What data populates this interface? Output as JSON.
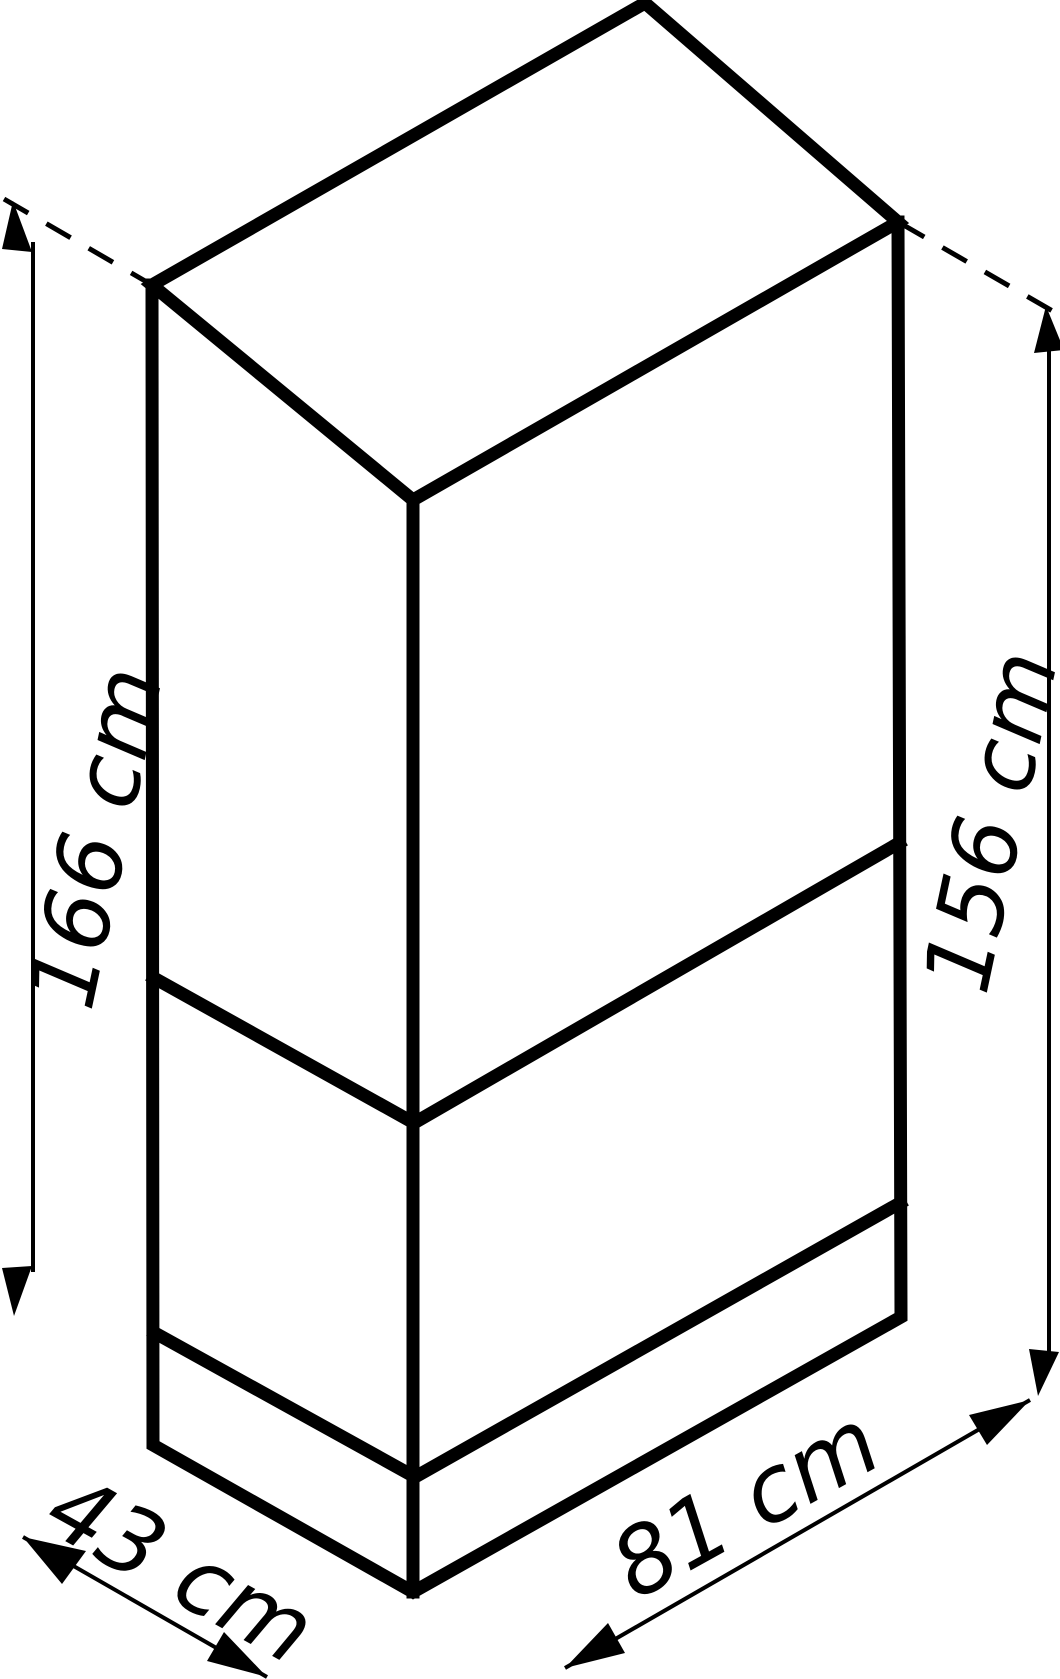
{
  "diagram": {
    "type": "product-dimensions-isometric-box",
    "labels": {
      "left_height": "166 cm",
      "right_height": "156 cm",
      "depth": "43 cm",
      "width": "81 cm"
    },
    "colors": {
      "line": "#000000",
      "background": "#ffffff"
    }
  }
}
